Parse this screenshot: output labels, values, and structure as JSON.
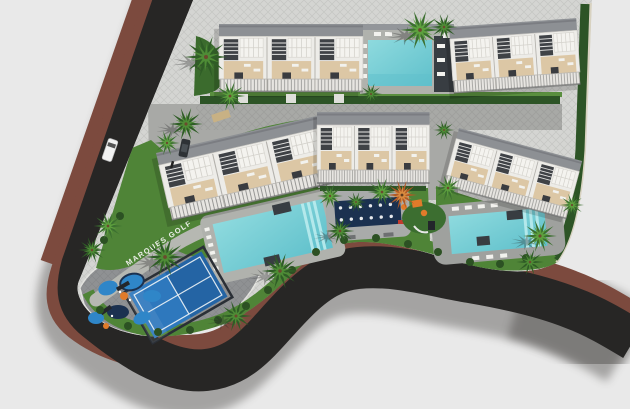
{
  "site": {
    "street_label": "MARQUES GOLF"
  },
  "palette": {
    "background": "#e9e9e9",
    "asphalt": "#272625",
    "sidewalk_terracotta": "#7c4a3e",
    "parcel_base": "#d4d5d2",
    "pavement": "#a8a9a6",
    "playground_pad": "#8f9193",
    "walkway": "#b6b8b2",
    "grass": "#4f8437",
    "hedge": "#2d5426",
    "pool_water": "#8edade",
    "pool_water_deep": "#5fc0cb",
    "deck_dark": "#383d42",
    "court_blue": "#2e78bd",
    "splash_blue": "#2f86c8",
    "lounge_navy": "#1b3150",
    "accent_orange": "#e07b2a",
    "building_wall": "#edece8",
    "building_terrace": "#dcc7a5",
    "roof_gray": "#8d9094"
  },
  "features": {
    "buildings_count": 5,
    "pools_count": 3,
    "amenity_labels": [
      "padel-court",
      "kids-splash-playground",
      "community-lounge-area",
      "children-playground"
    ]
  }
}
